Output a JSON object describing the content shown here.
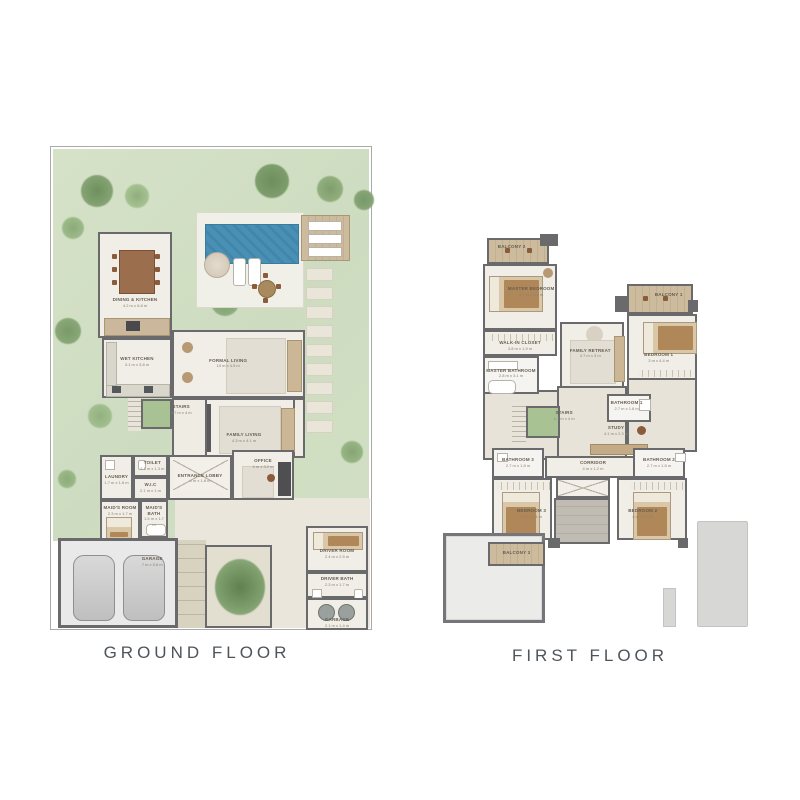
{
  "titles": {
    "ground": "GROUND FLOOR",
    "first": "FIRST FLOOR"
  },
  "palette": {
    "garden": "#d3dfc5",
    "pool": "#4a90b5",
    "wall": "#6a6a6c",
    "floor": "#f1eee7",
    "wood": "#c9b89d",
    "title": "#4d545a"
  },
  "ground": {
    "rooms": [
      {
        "label": "DINING & KITCHEN",
        "dims": "4.2 m x 6.8 m"
      },
      {
        "label": "WET KITCHEN",
        "dims": "3.1 m x 3.8 m"
      },
      {
        "label": "FORMAL LIVING",
        "dims": "10 m x 4.5 m"
      },
      {
        "label": "FAMILY LIVING",
        "dims": "4.3 m x 4.1 m"
      },
      {
        "label": "STAIRS",
        "dims": "1.7 m x 4 m"
      },
      {
        "label": "ENTRANCE LOBBY",
        "dims": "4 m x 1.8 m"
      },
      {
        "label": "OFFICE",
        "dims": "4 m x 3.2 m"
      },
      {
        "label": "TOILET",
        "dims": "2.1 m x 1.3 m"
      },
      {
        "label": "LAUNDRY",
        "dims": "1.7 m x 1.6 m"
      },
      {
        "label": "W.I.C",
        "dims": "2.1 m x 1 m"
      },
      {
        "label": "MAID'S BATH",
        "dims": "1.5 m x 1.7 m"
      },
      {
        "label": "MAID'S ROOM",
        "dims": "2.3 m x 1.7 m"
      },
      {
        "label": "GARAGE",
        "dims": "7 m x 5.6 m"
      },
      {
        "label": "DRIVER ROOM",
        "dims": "2.4 m x 2.5 m"
      },
      {
        "label": "DRIVER BATH",
        "dims": "2.3 m x 1.7 m"
      },
      {
        "label": "GARBAGE",
        "dims": "2.1 m x 1.4 m"
      }
    ]
  },
  "first": {
    "rooms": [
      {
        "label": "BALCONY 2",
        "dims": ""
      },
      {
        "label": "MASTER BEDROOM",
        "dims": "4.7 m x 3.8 m"
      },
      {
        "label": "WALK-IN CLOSET",
        "dims": "3.8 m x 1.9 m"
      },
      {
        "label": "MASTER BATHROOM",
        "dims": "2.8 m x 3.1 m"
      },
      {
        "label": "FAMILY RETREAT",
        "dims": "4.7 m x 3 m"
      },
      {
        "label": "BALCONY 1",
        "dims": ""
      },
      {
        "label": "BEDROOM 1",
        "dims": "3 m x 4.4 m"
      },
      {
        "label": "BATHROOM 1",
        "dims": "2.7 m x 1.8 m"
      },
      {
        "label": "STUDY",
        "dims": "4.1 m x 2.3 m"
      },
      {
        "label": "STAIRS",
        "dims": "1.7 m x 4 m"
      },
      {
        "label": "CORRIDOR",
        "dims": "4 m x 1.2 m"
      },
      {
        "label": "BATHROOM 3",
        "dims": "2.7 m x 1.8 m"
      },
      {
        "label": "BATHROOM 2",
        "dims": "2.7 m x 1.8 m"
      },
      {
        "label": "BEDROOM 3",
        "dims": "4 m x 3.4 m"
      },
      {
        "label": "BEDROOM 2",
        "dims": "4 m x 3.4 m"
      },
      {
        "label": "BALCONY 3",
        "dims": ""
      }
    ]
  }
}
